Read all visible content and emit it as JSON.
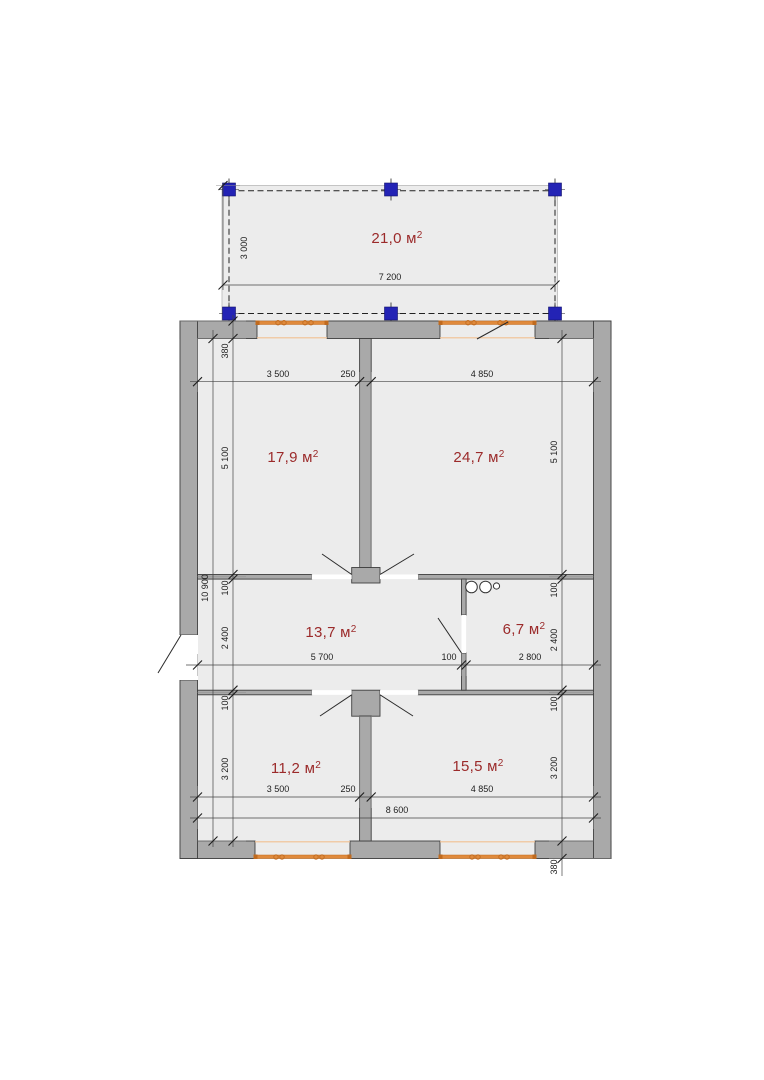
{
  "drawing_title": "floor-plan",
  "watermark": {
    "text": "ГИПЕРНН.РУ"
  },
  "colors": {
    "room_label_red": "#9b2a2a",
    "wall_gray": "#a9a9a9",
    "floor_fill": "#ececec",
    "window_orange": "#e08a3c",
    "window_orange_light": "#f2c091",
    "post_blue": "#2323b5",
    "dim_line": "#444444"
  },
  "rooms": [
    {
      "name": "terrace",
      "area": "21,0",
      "unit": "м",
      "sup": "2",
      "x": 397,
      "y": 243
    },
    {
      "name": "room-17-9",
      "area": "17,9",
      "unit": "м",
      "sup": "2",
      "x": 293,
      "y": 462
    },
    {
      "name": "room-24-7",
      "area": "24,7",
      "unit": "м",
      "sup": "2",
      "x": 479,
      "y": 462
    },
    {
      "name": "hall-13-7",
      "area": "13,7",
      "unit": "м",
      "sup": "2",
      "x": 331,
      "y": 637
    },
    {
      "name": "bath-6-7",
      "area": "6,7",
      "unit": "м",
      "sup": "2",
      "x": 524,
      "y": 634
    },
    {
      "name": "room-11-2",
      "area": "11,2",
      "unit": "м",
      "sup": "2",
      "x": 296,
      "y": 773
    },
    {
      "name": "room-15-5",
      "area": "15,5",
      "unit": "м",
      "sup": "2",
      "x": 478,
      "y": 771
    }
  ],
  "dimensions": [
    {
      "text": "7 200",
      "x": 390,
      "y": 280,
      "rot": 0
    },
    {
      "text": "3 000",
      "x": 247,
      "y": 248,
      "rot": -90
    },
    {
      "text": "3 500",
      "x": 278,
      "y": 377,
      "rot": 0
    },
    {
      "text": "250",
      "x": 348,
      "y": 377,
      "rot": 0
    },
    {
      "text": "4 850",
      "x": 482,
      "y": 377,
      "rot": 0
    },
    {
      "text": "380",
      "x": 228,
      "y": 351,
      "rot": -90
    },
    {
      "text": "5 100",
      "x": 228,
      "y": 458,
      "rot": -90
    },
    {
      "text": "10 900",
      "x": 208,
      "y": 588,
      "rot": -90
    },
    {
      "text": "100",
      "x": 228,
      "y": 588,
      "rot": -90
    },
    {
      "text": "2 400",
      "x": 228,
      "y": 638,
      "rot": -90
    },
    {
      "text": "100",
      "x": 228,
      "y": 703,
      "rot": -90
    },
    {
      "text": "3 200",
      "x": 228,
      "y": 769,
      "rot": -90
    },
    {
      "text": "5 700",
      "x": 322,
      "y": 660,
      "rot": 0
    },
    {
      "text": "100",
      "x": 449,
      "y": 660,
      "rot": 0
    },
    {
      "text": "2 800",
      "x": 530,
      "y": 660,
      "rot": 0
    },
    {
      "text": "5 100",
      "x": 557,
      "y": 452,
      "rot": -90
    },
    {
      "text": "100",
      "x": 557,
      "y": 590,
      "rot": -90
    },
    {
      "text": "2 400",
      "x": 557,
      "y": 640,
      "rot": -90
    },
    {
      "text": "100",
      "x": 557,
      "y": 704,
      "rot": -90
    },
    {
      "text": "3 200",
      "x": 557,
      "y": 768,
      "rot": -90
    },
    {
      "text": "380",
      "x": 557,
      "y": 867,
      "rot": -90
    },
    {
      "text": "3 500",
      "x": 278,
      "y": 792,
      "rot": 0
    },
    {
      "text": "250",
      "x": 348,
      "y": 792,
      "rot": 0
    },
    {
      "text": "4 850",
      "x": 482,
      "y": 792,
      "rot": 0
    },
    {
      "text": "8 600",
      "x": 397,
      "y": 813,
      "rot": 0
    }
  ]
}
